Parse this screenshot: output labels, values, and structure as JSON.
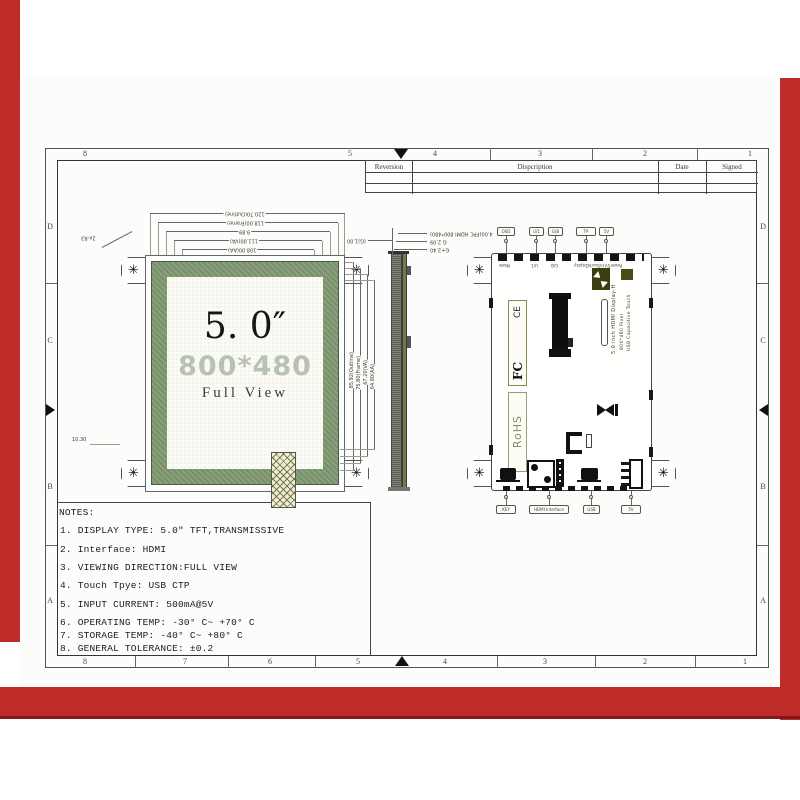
{
  "colors": {
    "frame_red": "#bf2b28",
    "frame_red_dark": "#7e1a17",
    "bezel_green": "#7f9671",
    "resolution_gray": "#b7c2b2"
  },
  "icons": {
    "screw": "✳"
  },
  "zones": {
    "top": [
      "8",
      "5",
      "4",
      "3",
      "2",
      "1"
    ],
    "bottom": [
      "8",
      "7",
      "6",
      "5",
      "4",
      "3",
      "2",
      "1"
    ],
    "left": [
      "D",
      "C",
      "B",
      "A"
    ],
    "right": [
      "D",
      "C",
      "B",
      "A"
    ]
  },
  "title_block": {
    "headers": [
      "Reversion",
      "Dispcription",
      "Date",
      "Signed"
    ]
  },
  "front_view": {
    "size_label": "5. 0″",
    "resolution": "800*480",
    "view_label": "Full View",
    "corner_note": "2x-R3",
    "left_note": "10.30",
    "top_dims": [
      "120.70(Outline)",
      "118.00(Frame)",
      "9.89",
      "111.00(VA)",
      "108.00(AA)"
    ],
    "right_dims": [
      "85.92(Outline)",
      "75.80(Frame)",
      "67.20(VA)",
      "64.80(AA)"
    ]
  },
  "side_view": {
    "right_dims": [
      "4.00(FPC HDMI 800*480)",
      "G 2.09",
      "G+2.40"
    ],
    "left_dim": "(G)1.00"
  },
  "back_view": {
    "top_callouts": [
      "OSD",
      "U/1",
      "G/B",
      "TP",
      "5V"
    ],
    "edge_labels": [
      "Mode",
      "U/1",
      "G/B",
      "TouchDisplay",
      "Power5V-In"
    ],
    "board_text": [
      "5.0 inch HDMI Display-H",
      "800*480 Pixel",
      "USB Capacitive Touch"
    ],
    "cert_marks": {
      "fcc": "FC",
      "ce": "CE",
      "rohs": "RoHS"
    },
    "bottom_callouts": [
      "KEY",
      "HDMI Interface",
      "USB",
      "5V"
    ]
  },
  "notes": {
    "title": "NOTES:",
    "lines": [
      "1. DISPLAY TYPE: 5.0″ TFT,TRANSMISSIVE",
      "2. Interface: HDMI",
      "3. VIEWING DIRECTION:FULL VIEW",
      "4. Touch Tpye: USB CTP",
      "5. INPUT CURRENT: 500mA@5V",
      "6. OPERATING TEMP: -30° C~ +70° C",
      "7. STORAGE TEMP: -40° C~ +80° C",
      "8. GENERAL TOLERANCE: ±0.2"
    ]
  }
}
